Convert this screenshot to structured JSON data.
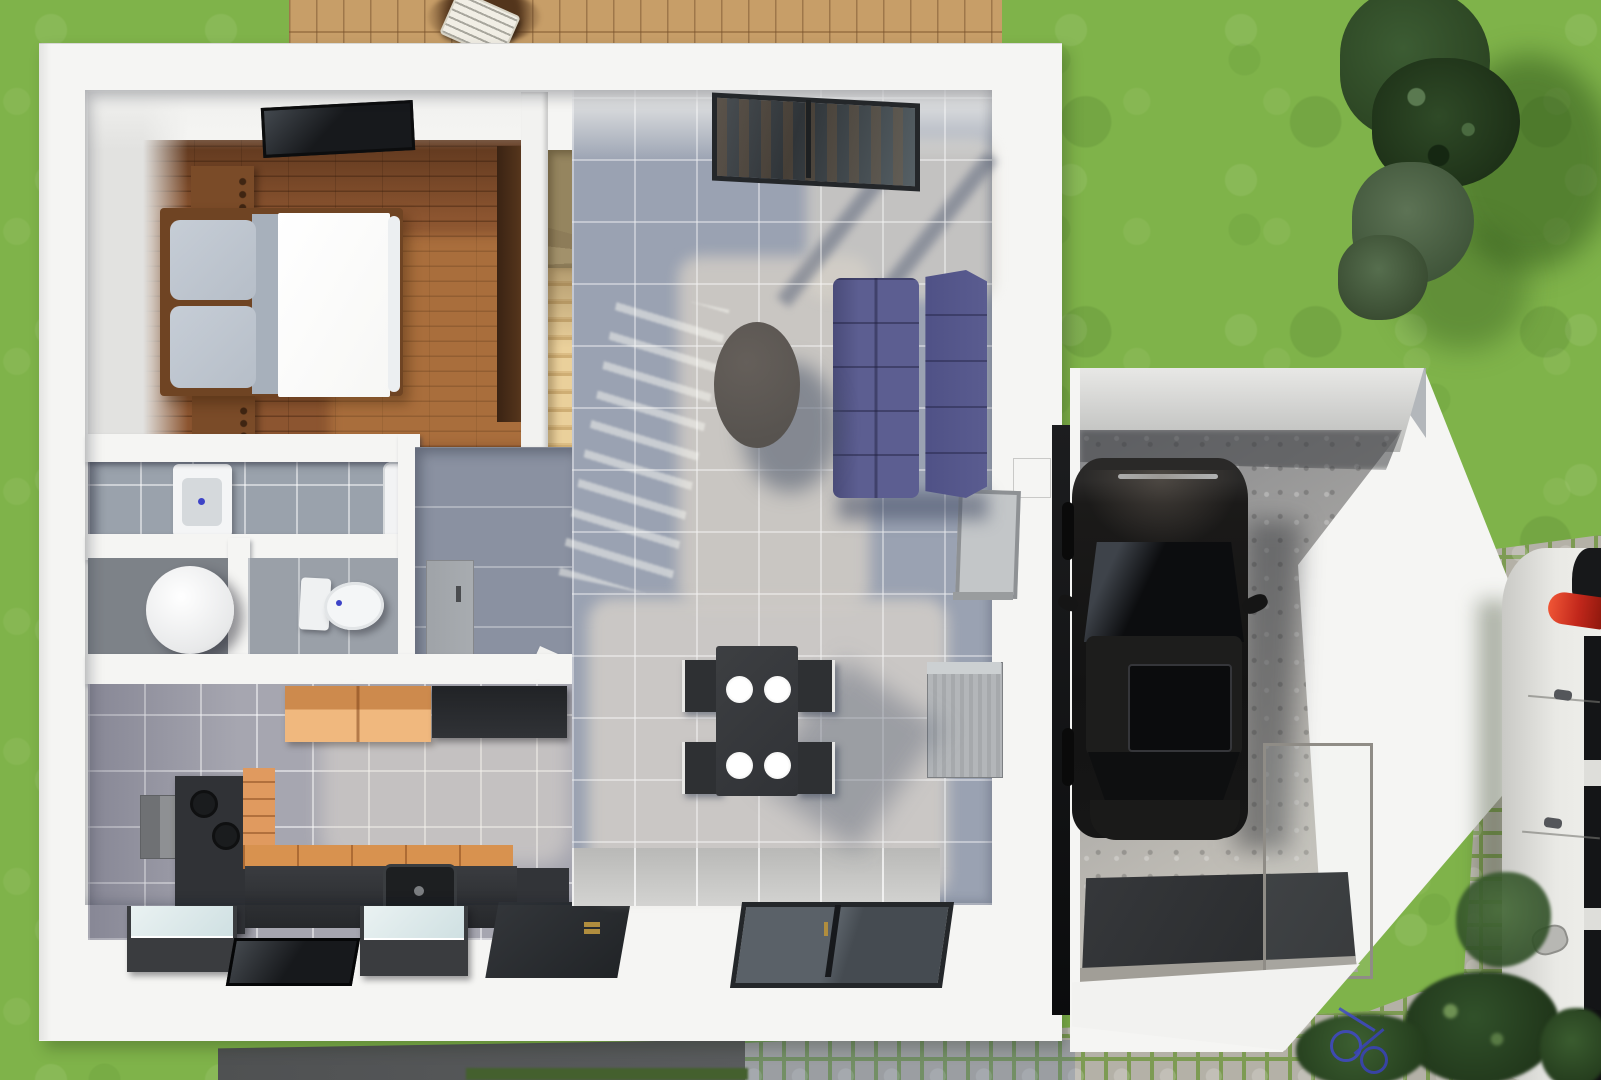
{
  "scene": {
    "title": "3D top-down floor plan rendering",
    "description": "Bird's-eye 3D architectural render of a single-storey house with attached garage, rear wood deck with sun lounger, lawn, conifer shrubs, cobblestone driveway, a black car parked in the garage and a white car parked along the right edge",
    "view": "top-down",
    "rooms": [
      {
        "name": "bedroom",
        "floor": "dark wood planks",
        "contents": [
          "double bed with white duvet and grey pillows",
          "two wooden nightstands",
          "tall wardrobe",
          "ceiling skylight"
        ]
      },
      {
        "name": "bathroom",
        "floor": "grey tile",
        "contents": [
          "square washbasin",
          "shower screen"
        ]
      },
      {
        "name": "shower-room",
        "floor": "dark grey tile",
        "contents": [
          "round shower basin"
        ]
      },
      {
        "name": "wc",
        "floor": "grey tile",
        "contents": [
          "toilet with cistern"
        ]
      },
      {
        "name": "hallway",
        "floor": "blue-grey tile",
        "contents": [
          "open interior door leaf",
          "dark built-in closet",
          "angled under-stair wall"
        ]
      },
      {
        "name": "kitchen",
        "floor": "lavender-grey tile",
        "contents": [
          "orange wall cabinets",
          "dark wall cabinet",
          "extractor box",
          "cooktop column with two burners",
          "orange drawer column",
          "worktop with inset sink",
          "two appliances with glass lids",
          "casement window",
          "entry door with brass handle"
        ]
      },
      {
        "name": "living-dining",
        "floor": "grey tile with white grout",
        "contents": [
          "L-shaped winder staircase in light wood",
          "purple tufted sofa",
          "round dark coffee table",
          "charcoal dining table with four white plates",
          "four dark chairs",
          "ribbed radiator",
          "patio glass door",
          "double casement window",
          "wall niche",
          "wall-mounted window panel"
        ]
      },
      {
        "name": "garage",
        "floor": "concrete",
        "contents": [
          "black car seen from above",
          "dark entrance mat",
          "metal sill",
          "glass balustrade",
          "gabled roof edge pointing right"
        ]
      }
    ],
    "exterior": [
      "lawn",
      "wood deck",
      "sun lounger",
      "parasol shadow",
      "conifer trees",
      "tree shadows",
      "cobblestone pavers",
      "dark terrace strip",
      "hedge strip",
      "white car with red taillight",
      "bushes",
      "blue bicycle fragment"
    ]
  },
  "colors": {
    "grass": "#7fb34a",
    "deck": "#c79e68",
    "deck_dark": "#53351c",
    "wall": "#f5f5f3",
    "tile_shadow": "#9aa2b2",
    "tile_light": "#cdc9c2",
    "tile_hall": "#8a91a1",
    "tile_bath": "#9aa2ac",
    "wood_floor": "#8c5530",
    "stair_light": "#ead09b",
    "stair_dark": "#95855f",
    "wardrobe": "#52331b",
    "bedframe": "#6f4423",
    "pillow": "#b6bec8",
    "duvet": "#f7f7f5",
    "sofa": "#5c5e91",
    "sofa_dark": "#4e5085",
    "coffee_table": "#57534f",
    "charcoal": "#303236",
    "counter_orange": "#d8924f",
    "cabinet_orange": "#edb377",
    "glass_dark": "#17191c",
    "appliance_glass": "#cfe0e2",
    "concrete": "#a3a2a0",
    "car_black": "#131313",
    "car_white": "#e9e9e5",
    "taillight": "#c1271b",
    "paver": "#b4b1a7",
    "moss": "#7d9b53",
    "tree": "#2c4523",
    "terrace": "#5a5c5e",
    "door_gray": "#a8acb0",
    "brass": "#b08d3e",
    "navy_closet": "#262a33",
    "radiator": "#a6a9ac",
    "shadow_blue": "#7e88a0"
  }
}
